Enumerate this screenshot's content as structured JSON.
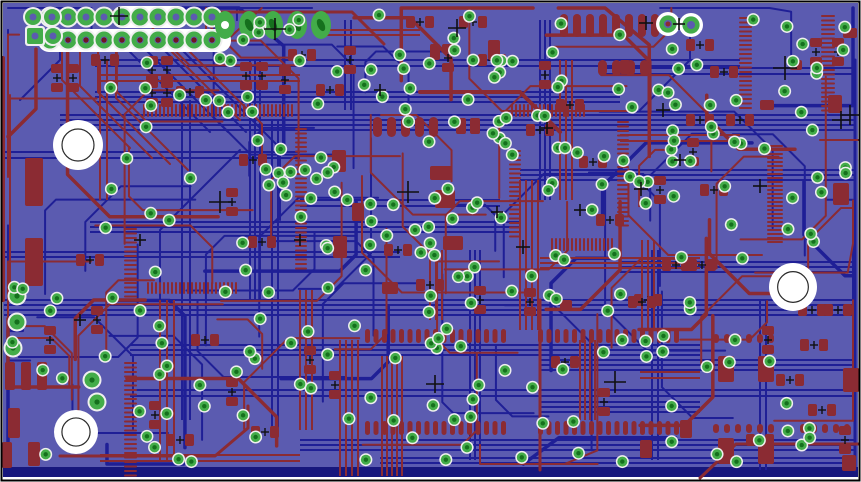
{
  "colors": {
    "page": "#ffffff",
    "frame": "#000000",
    "board": "#5b5bb0",
    "copper_top": "#8b2b33",
    "copper_bottom": "#1f1f96",
    "edge_bar": "#17177d",
    "via_green": "#43ac49",
    "via_core": "#15701d",
    "halo": "#efefef",
    "hole_white": "#ffffff",
    "hole_ring": "#2b2b2b",
    "pin_dot": "#6e1822",
    "mark": "#101010"
  },
  "board": {
    "x": 3,
    "y": 3,
    "w": 855,
    "h": 474,
    "edge_bar": {
      "x": 3,
      "y": 467,
      "w": 855,
      "h": 10
    }
  },
  "mounting_holes": [
    {
      "cx": 78,
      "cy": 145,
      "r": 25
    },
    {
      "cx": 76,
      "cy": 432,
      "r": 22
    },
    {
      "cx": 793,
      "cy": 287,
      "r": 24
    }
  ],
  "plated_holes": [
    {
      "cx": 668,
      "cy": 24,
      "r": 12,
      "center": "red"
    },
    {
      "cx": 691,
      "cy": 25,
      "r": 12,
      "center": "board"
    }
  ],
  "header": {
    "x0": 50,
    "y_row1": 17,
    "y_row2": 40,
    "pitch": 18,
    "cols": 10,
    "pad_r": 8.5,
    "halo_r": 10.5,
    "hole_r": 3.5,
    "pin_r": 2.6,
    "strips": [
      {
        "x": 112,
        "y": 6,
        "w": 76,
        "h": 22,
        "rx": 10
      },
      {
        "x": 38,
        "y": 29,
        "w": 193,
        "h": 23,
        "rx": 11
      }
    ]
  },
  "quad_pads": [
    {
      "cx": 33,
      "cy": 17,
      "square": false
    },
    {
      "cx": 52,
      "cy": 17,
      "square": false
    },
    {
      "cx": 35,
      "cy": 36,
      "square": true
    },
    {
      "cx": 53,
      "cy": 36,
      "square": false
    }
  ],
  "oval_pads": {
    "cy": 25,
    "rx": 10,
    "ry": 14,
    "xs": [
      225,
      249,
      273,
      297,
      321
    ]
  },
  "green_pads": [
    {
      "cx": 17,
      "cy": 296
    },
    {
      "cx": 17,
      "cy": 322
    },
    {
      "cx": 13,
      "cy": 348
    },
    {
      "cx": 92,
      "cy": 380
    },
    {
      "cx": 97,
      "cy": 402
    }
  ],
  "combs": [
    {
      "x": 143,
      "y": 104,
      "n": 38,
      "pitch": 4,
      "w": 2,
      "len": 13,
      "o": "h",
      "d": 1
    },
    {
      "x": 511,
      "y": 104,
      "n": 19,
      "pitch": 4,
      "w": 2,
      "len": 13,
      "o": "h",
      "d": 1
    },
    {
      "x": 147,
      "y": 282,
      "n": 23,
      "pitch": 4,
      "w": 2,
      "len": 12,
      "o": "h",
      "d": 1
    },
    {
      "x": 551,
      "y": 238,
      "n": 16,
      "pitch": 4,
      "w": 2,
      "len": 13,
      "o": "h",
      "d": 1
    },
    {
      "x": 124,
      "y": 228,
      "n": 16,
      "pitch": 4.5,
      "w": 2,
      "len": 13,
      "o": "v",
      "d": 1
    },
    {
      "x": 124,
      "y": 362,
      "n": 26,
      "pitch": 4.5,
      "w": 2,
      "len": 13,
      "o": "v",
      "d": 1
    },
    {
      "x": 307,
      "y": 128,
      "n": 32,
      "pitch": 4.5,
      "w": 2,
      "len": 12,
      "o": "v",
      "d": -1
    },
    {
      "x": 509,
      "y": 150,
      "n": 20,
      "pitch": 4.5,
      "w": 2,
      "len": 12,
      "o": "v",
      "d": 1
    },
    {
      "x": 629,
      "y": 121,
      "n": 24,
      "pitch": 4.5,
      "w": 2,
      "len": 12,
      "o": "v",
      "d": -1
    },
    {
      "x": 752,
      "y": 17,
      "n": 21,
      "pitch": 4.5,
      "w": 2,
      "len": 13,
      "o": "v",
      "d": -1
    },
    {
      "x": 835,
      "y": 15,
      "n": 22,
      "pitch": 4.5,
      "w": 2,
      "len": 14,
      "o": "v",
      "d": -1
    },
    {
      "x": 783,
      "y": 145,
      "n": 25,
      "pitch": 4,
      "w": 2,
      "len": 16,
      "o": "v",
      "d": -1
    },
    {
      "x": 365,
      "y": 329,
      "n": 17,
      "pitch": 8.5,
      "w": 5,
      "len": 14,
      "o": "h",
      "d": 1
    },
    {
      "x": 538,
      "y": 329,
      "n": 17,
      "pitch": 8.5,
      "w": 5,
      "len": 14,
      "o": "h",
      "d": 1
    },
    {
      "x": 365,
      "y": 421,
      "n": 17,
      "pitch": 8.5,
      "w": 5,
      "len": 14,
      "o": "h",
      "d": 1
    },
    {
      "x": 538,
      "y": 421,
      "n": 17,
      "pitch": 8.5,
      "w": 5,
      "len": 14,
      "o": "h",
      "d": 1
    },
    {
      "x": 560,
      "y": 14,
      "n": 8,
      "pitch": 13,
      "w": 8,
      "len": 23,
      "o": "h",
      "d": 1
    },
    {
      "x": 598,
      "y": 60,
      "n": 4,
      "pitch": 14,
      "w": 9,
      "len": 16,
      "o": "h",
      "d": 1
    },
    {
      "x": 373,
      "y": 117,
      "n": 5,
      "pitch": 14,
      "w": 9,
      "len": 20,
      "o": "h",
      "d": 1
    },
    {
      "x": 713,
      "y": 334,
      "n": 6,
      "pitch": 11,
      "w": 6,
      "len": 9,
      "o": "h",
      "d": 1
    },
    {
      "x": 713,
      "y": 424,
      "n": 6,
      "pitch": 11,
      "w": 6,
      "len": 9,
      "o": "h",
      "d": 1
    },
    {
      "x": 800,
      "y": 424,
      "n": 5,
      "pitch": 11,
      "w": 6,
      "len": 9,
      "o": "h",
      "d": 1
    }
  ],
  "rpads": [
    [
      152,
      70,
      "v"
    ],
    [
      167,
      70,
      "v"
    ],
    [
      152,
      93,
      "v"
    ],
    [
      167,
      93,
      "v"
    ],
    [
      190,
      92,
      "h"
    ],
    [
      246,
      76,
      "v"
    ],
    [
      262,
      76,
      "v"
    ],
    [
      285,
      80,
      "v"
    ],
    [
      57,
      78,
      "v"
    ],
    [
      73,
      78,
      "v"
    ],
    [
      420,
      22,
      "h"
    ],
    [
      448,
      58,
      "v"
    ],
    [
      473,
      22,
      "h"
    ],
    [
      492,
      60,
      "h"
    ],
    [
      545,
      75,
      "v"
    ],
    [
      253,
      160,
      "h"
    ],
    [
      232,
      202,
      "v"
    ],
    [
      262,
      242,
      "h"
    ],
    [
      205,
      340,
      "h"
    ],
    [
      232,
      392,
      "v"
    ],
    [
      265,
      432,
      "h"
    ],
    [
      700,
      45,
      "h"
    ],
    [
      724,
      72,
      "h"
    ],
    [
      693,
      152,
      "v"
    ],
    [
      714,
      190,
      "h"
    ],
    [
      648,
      300,
      "h"
    ],
    [
      530,
      302,
      "v"
    ],
    [
      565,
      362,
      "h"
    ],
    [
      604,
      402,
      "v"
    ],
    [
      642,
      302,
      "h"
    ],
    [
      593,
      162,
      "h"
    ],
    [
      676,
      265,
      "h"
    ],
    [
      702,
      265,
      "h"
    ],
    [
      816,
      52,
      "v"
    ],
    [
      838,
      52,
      "v"
    ],
    [
      812,
      310,
      "h"
    ],
    [
      838,
      310,
      "h"
    ],
    [
      814,
      345,
      "h"
    ],
    [
      822,
      410,
      "h"
    ],
    [
      845,
      440,
      "v"
    ],
    [
      50,
      340,
      "v"
    ],
    [
      97,
      320,
      "v"
    ],
    [
      90,
      260,
      "h"
    ],
    [
      105,
      60,
      "h"
    ],
    [
      130,
      40,
      "h"
    ],
    [
      350,
      60,
      "v"
    ],
    [
      330,
      90,
      "h"
    ],
    [
      302,
      55,
      "h"
    ],
    [
      398,
      250,
      "h"
    ],
    [
      430,
      285,
      "h"
    ],
    [
      480,
      300,
      "v"
    ],
    [
      180,
      440,
      "h"
    ],
    [
      155,
      415,
      "v"
    ],
    [
      610,
      220,
      "h"
    ],
    [
      660,
      190,
      "v"
    ],
    [
      700,
      120,
      "h"
    ],
    [
      740,
      120,
      "h"
    ],
    [
      768,
      340,
      "v"
    ],
    [
      790,
      380,
      "h"
    ],
    [
      760,
      440,
      "h"
    ],
    [
      335,
      385,
      "v"
    ],
    [
      310,
      360,
      "v"
    ],
    [
      540,
      130,
      "h"
    ],
    [
      570,
      105,
      "h"
    ]
  ],
  "bigrects": [
    [
      25,
      158,
      18,
      48
    ],
    [
      25,
      238,
      18,
      48
    ],
    [
      5,
      362,
      10,
      28
    ],
    [
      21,
      362,
      10,
      28
    ],
    [
      37,
      362,
      10,
      28
    ],
    [
      8,
      408,
      12,
      30
    ],
    [
      2,
      442,
      10,
      26
    ],
    [
      28,
      442,
      12,
      24
    ],
    [
      332,
      150,
      14,
      22
    ],
    [
      430,
      166,
      22,
      14
    ],
    [
      435,
      190,
      20,
      18
    ],
    [
      443,
      236,
      20,
      14
    ],
    [
      333,
      236,
      14,
      22
    ],
    [
      352,
      203,
      12,
      18
    ],
    [
      382,
      282,
      16,
      12
    ],
    [
      718,
      356,
      16,
      26
    ],
    [
      758,
      356,
      16,
      26
    ],
    [
      718,
      438,
      16,
      26
    ],
    [
      758,
      438,
      16,
      26
    ],
    [
      833,
      183,
      16,
      22
    ],
    [
      843,
      28,
      14,
      10
    ],
    [
      828,
      95,
      14,
      18
    ],
    [
      843,
      368,
      16,
      24
    ],
    [
      842,
      455,
      14,
      16
    ],
    [
      456,
      118,
      10,
      16
    ],
    [
      470,
      118,
      10,
      16
    ],
    [
      488,
      40,
      12,
      20
    ],
    [
      430,
      44,
      10,
      16
    ],
    [
      560,
      300,
      12,
      10
    ],
    [
      620,
      60,
      10,
      14
    ],
    [
      760,
      100,
      14,
      10
    ],
    [
      790,
      60,
      12,
      10
    ],
    [
      680,
      420,
      12,
      18
    ],
    [
      640,
      440,
      12,
      18
    ]
  ],
  "red_polylines": [
    {
      "pts": [
        [
          62,
          50
        ],
        [
          62,
          80
        ],
        [
          130,
          148
        ]
      ],
      "w": 2
    },
    {
      "pts": [
        [
          80,
          50
        ],
        [
          80,
          86
        ],
        [
          152,
          158
        ]
      ],
      "w": 2
    },
    {
      "pts": [
        [
          98,
          50
        ],
        [
          98,
          92
        ],
        [
          170,
          164
        ]
      ],
      "w": 2
    },
    {
      "pts": [
        [
          116,
          50
        ],
        [
          116,
          98
        ],
        [
          188,
          170
        ]
      ],
      "w": 2
    },
    {
      "pts": [
        [
          170,
          50
        ],
        [
          240,
          120
        ]
      ],
      "w": 2
    },
    {
      "pts": [
        [
          188,
          50
        ],
        [
          262,
          124
        ],
        [
          262,
          170
        ]
      ],
      "w": 2
    },
    {
      "pts": [
        [
          96,
          12
        ],
        [
          352,
          12
        ],
        [
          384,
          44
        ]
      ],
      "w": 3
    },
    {
      "pts": [
        [
          3,
          58
        ],
        [
          3,
          300
        ]
      ],
      "w": 4
    },
    {
      "pts": [
        [
          10,
          95
        ],
        [
          10,
          292
        ]
      ],
      "w": 2
    },
    {
      "pts": [
        [
          60,
          456
        ],
        [
          215,
          456
        ],
        [
          248,
          428
        ],
        [
          248,
          406
        ]
      ],
      "w": 3
    },
    {
      "pts": [
        [
          420,
          92
        ],
        [
          520,
          92
        ],
        [
          560,
          132
        ]
      ],
      "w": 4
    },
    {
      "pts": [
        [
          700,
          478
        ],
        [
          736,
          444
        ],
        [
          858,
          444
        ]
      ],
      "w": 3
    },
    {
      "pts": [
        [
          206,
          8
        ],
        [
          206,
          40
        ]
      ],
      "w": 2
    },
    {
      "pts": [
        [
          540,
          300
        ],
        [
          540,
          470
        ]
      ],
      "w": 3
    },
    {
      "pts": [
        [
          820,
          140
        ],
        [
          858,
          140
        ]
      ],
      "w": 2
    }
  ],
  "blue_polylines": [
    {
      "pts": [
        [
          122,
          44
        ],
        [
          210,
          132
        ]
      ],
      "w": 2
    },
    {
      "pts": [
        [
          140,
          44
        ],
        [
          228,
          132
        ]
      ],
      "w": 2
    },
    {
      "pts": [
        [
          158,
          44
        ],
        [
          246,
          132
        ]
      ],
      "w": 2
    },
    {
      "pts": [
        [
          60,
          44
        ],
        [
          60,
          60
        ],
        [
          20,
          100
        ]
      ],
      "w": 2
    },
    {
      "pts": [
        [
          176,
          44
        ],
        [
          280,
          148
        ],
        [
          280,
          220
        ]
      ],
      "w": 2
    },
    {
      "pts": [
        [
          855,
          60
        ],
        [
          855,
          470
        ]
      ],
      "w": 3
    },
    {
      "pts": [
        [
          240,
          150
        ],
        [
          160,
          230
        ],
        [
          160,
          330
        ]
      ],
      "w": 2
    },
    {
      "pts": [
        [
          690,
          30
        ],
        [
          690,
          60
        ],
        [
          640,
          110
        ]
      ],
      "w": 2
    }
  ],
  "blue_h_buses": [
    {
      "y": 60,
      "x0": 95,
      "x1": 740,
      "n": 2,
      "gap": 6
    },
    {
      "y": 92,
      "x0": 95,
      "x1": 620,
      "n": 3,
      "gap": 5
    },
    {
      "y": 115,
      "x0": 60,
      "x1": 855,
      "n": 4,
      "gap": 5
    },
    {
      "y": 152,
      "x0": 4,
      "x1": 300,
      "n": 2,
      "gap": 6
    },
    {
      "y": 170,
      "x0": 520,
      "x1": 855,
      "n": 3,
      "gap": 5
    },
    {
      "y": 222,
      "x0": 90,
      "x1": 520,
      "n": 3,
      "gap": 5
    },
    {
      "y": 252,
      "x0": 4,
      "x1": 400,
      "n": 2,
      "gap": 5
    },
    {
      "y": 262,
      "x0": 620,
      "x1": 855,
      "n": 3,
      "gap": 5
    },
    {
      "y": 300,
      "x0": 4,
      "x1": 855,
      "n": 4,
      "gap": 5
    },
    {
      "y": 345,
      "x0": 130,
      "x1": 700,
      "n": 3,
      "gap": 5
    },
    {
      "y": 360,
      "x0": 540,
      "x1": 855,
      "n": 3,
      "gap": 5
    },
    {
      "y": 390,
      "x0": 130,
      "x1": 855,
      "n": 2,
      "gap": 6
    },
    {
      "y": 402,
      "x0": 540,
      "x1": 700,
      "n": 3,
      "gap": 5
    },
    {
      "y": 440,
      "x0": 300,
      "x1": 855,
      "n": 3,
      "gap": 5
    },
    {
      "y": 458,
      "x0": 380,
      "x1": 855,
      "n": 2,
      "gap": 5
    },
    {
      "y": 68,
      "x0": 600,
      "x1": 855,
      "n": 2,
      "gap": 6
    },
    {
      "y": 200,
      "x0": 300,
      "x1": 500,
      "n": 2,
      "gap": 6
    }
  ],
  "blue_v_buses": [
    {
      "x": 250,
      "y0": 60,
      "y1": 300,
      "n": 3,
      "gap": 5
    },
    {
      "x": 272,
      "y0": 120,
      "y1": 430,
      "n": 2,
      "gap": 6
    },
    {
      "x": 540,
      "y0": 20,
      "y1": 200,
      "n": 3,
      "gap": 5
    },
    {
      "x": 470,
      "y0": 250,
      "y1": 460,
      "n": 3,
      "gap": 5
    },
    {
      "x": 652,
      "y0": 250,
      "y1": 460,
      "n": 2,
      "gap": 6
    },
    {
      "x": 182,
      "y0": 100,
      "y1": 420,
      "n": 2,
      "gap": 8
    },
    {
      "x": 345,
      "y0": 20,
      "y1": 110,
      "n": 2,
      "gap": 6
    },
    {
      "x": 760,
      "y0": 300,
      "y1": 470,
      "n": 2,
      "gap": 6
    }
  ],
  "red_v_buses": [
    {
      "x": 340,
      "y0": 340,
      "y1": 476,
      "n": 4,
      "gap": 6
    },
    {
      "x": 382,
      "y0": 356,
      "y1": 476,
      "n": 5,
      "gap": 5
    },
    {
      "x": 520,
      "y0": 180,
      "y1": 330,
      "n": 4,
      "gap": 6
    },
    {
      "x": 560,
      "y0": 60,
      "y1": 200,
      "n": 3,
      "gap": 6
    },
    {
      "x": 580,
      "y0": 340,
      "y1": 420,
      "n": 4,
      "gap": 5
    },
    {
      "x": 642,
      "y0": 240,
      "y1": 330,
      "n": 3,
      "gap": 6
    },
    {
      "x": 160,
      "y0": 300,
      "y1": 460,
      "n": 3,
      "gap": 7
    },
    {
      "x": 100,
      "y0": 60,
      "y1": 200,
      "n": 2,
      "gap": 7
    },
    {
      "x": 300,
      "y0": 290,
      "y1": 430,
      "n": 3,
      "gap": 6
    },
    {
      "x": 430,
      "y0": 250,
      "y1": 320,
      "n": 3,
      "gap": 6
    }
  ],
  "red_h_buses": [
    {
      "y": 75,
      "x0": 100,
      "x1": 300,
      "n": 2,
      "gap": 6
    },
    {
      "y": 258,
      "x0": 540,
      "x1": 700,
      "n": 3,
      "gap": 5
    },
    {
      "y": 372,
      "x0": 640,
      "x1": 700,
      "n": 2,
      "gap": 6
    },
    {
      "y": 455,
      "x0": 100,
      "x1": 300,
      "n": 2,
      "gap": 6
    },
    {
      "y": 135,
      "x0": 620,
      "x1": 740,
      "n": 2,
      "gap": 6
    },
    {
      "y": 30,
      "x0": 320,
      "x1": 420,
      "n": 2,
      "gap": 5
    }
  ],
  "scatter": {
    "seed_red": 11,
    "n_red": 58,
    "seed_blue": 23,
    "n_blue": 46,
    "seed_vias": 5
  },
  "via_regions": [
    {
      "x0": 95,
      "y0": 55,
      "x1": 300,
      "y1": 465,
      "n": 55
    },
    {
      "x0": 300,
      "y0": 120,
      "x1": 560,
      "y1": 465,
      "n": 78
    },
    {
      "x0": 560,
      "y0": 12,
      "x1": 855,
      "y1": 250,
      "n": 55
    },
    {
      "x0": 560,
      "y0": 250,
      "x1": 855,
      "y1": 465,
      "n": 32
    },
    {
      "x0": 300,
      "y0": 10,
      "x1": 560,
      "y1": 120,
      "n": 26
    },
    {
      "x0": 6,
      "y0": 275,
      "x1": 95,
      "y1": 465,
      "n": 8
    },
    {
      "x0": 95,
      "y0": 8,
      "x1": 300,
      "y1": 55,
      "n": 6
    }
  ],
  "via_style": {
    "r_halo": 6.5,
    "r_green": 5,
    "r_core": 2.2
  },
  "crosshairs": [
    [
      119,
      16,
      9
    ],
    [
      275,
      29,
      11
    ],
    [
      457,
      28,
      9
    ],
    [
      646,
      23,
      7
    ],
    [
      679,
      24,
      6
    ],
    [
      785,
      68,
      12
    ],
    [
      408,
      192,
      11
    ],
    [
      220,
      202,
      11
    ],
    [
      615,
      382,
      11
    ],
    [
      435,
      384,
      9
    ],
    [
      760,
      186,
      7
    ],
    [
      841,
      120,
      9
    ],
    [
      641,
      189,
      7
    ],
    [
      523,
      247,
      7
    ],
    [
      497,
      212,
      6
    ],
    [
      663,
      110,
      7
    ],
    [
      580,
      210,
      6
    ],
    [
      547,
      128,
      6
    ],
    [
      380,
      90,
      6
    ],
    [
      300,
      240,
      6
    ],
    [
      850,
      115,
      10
    ],
    [
      80,
      320,
      6
    ],
    [
      140,
      240,
      6
    ],
    [
      680,
      160,
      6
    ]
  ]
}
